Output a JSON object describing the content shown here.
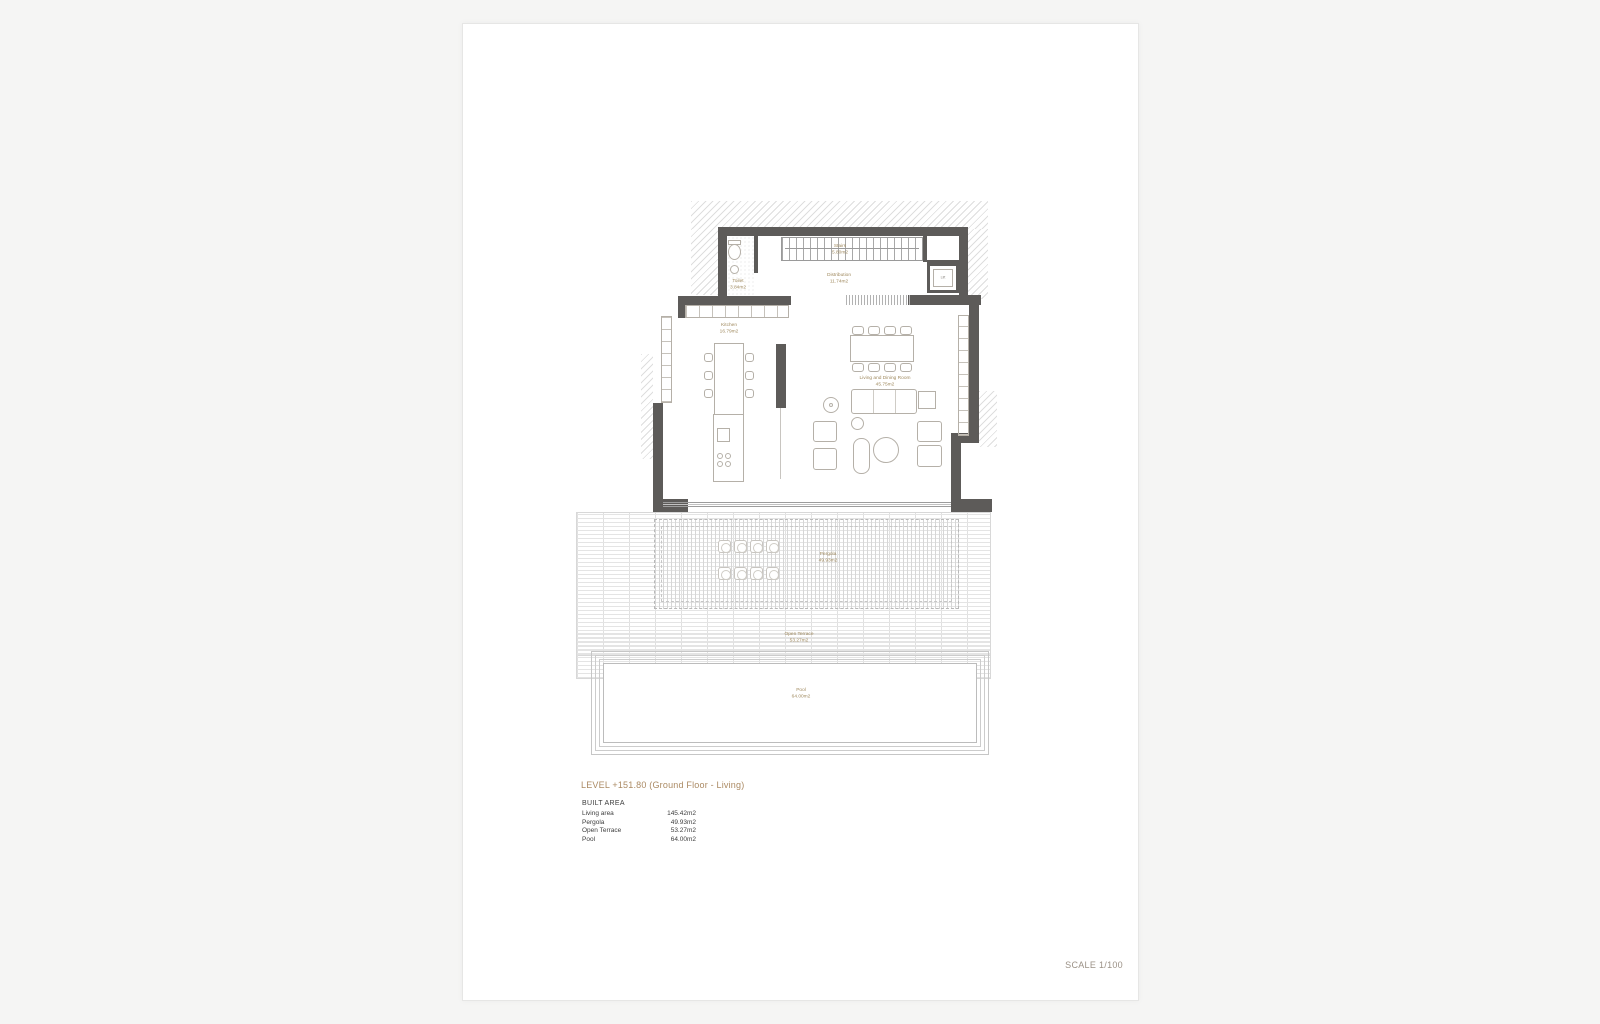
{
  "sheet": {
    "scale_label": "SCALE 1/100"
  },
  "title_block": {
    "level_title": "LEVEL +151.80 (Ground Floor - Living)",
    "built_area_heading": "BUILT AREA",
    "areas": [
      {
        "label": "Living area",
        "value": "145.42m2"
      },
      {
        "label": "Pergola",
        "value": "49.93m2"
      },
      {
        "label": "Open Terrace",
        "value": "53.27m2"
      },
      {
        "label": "Pool",
        "value": "64.00m2"
      }
    ]
  },
  "plan": {
    "rooms": {
      "toilet": {
        "name": "Toilet",
        "area": "3.84m2"
      },
      "stairs": {
        "name": "Stairs",
        "area": "5.80m2"
      },
      "distribution": {
        "name": "Distribution",
        "area": "11.74m2"
      },
      "kitchen": {
        "name": "Kitchen",
        "area": "16.79m2"
      },
      "living": {
        "name": "Living and Dining Room",
        "area": "45.75m2"
      },
      "pergola": {
        "name": "Pergola",
        "area": "49.93m2"
      },
      "open_terrace": {
        "name": "Open Terrace",
        "area": "53.27m2"
      },
      "pool": {
        "name": "Pool",
        "area": "64.00m2"
      }
    },
    "lift_label": "Lift",
    "colors": {
      "wall": "#5d5b59",
      "room_label": "#a08a5f",
      "title_accent": "#ab8a63",
      "scale_text": "#9b9186",
      "paper": "#ffffff"
    }
  }
}
